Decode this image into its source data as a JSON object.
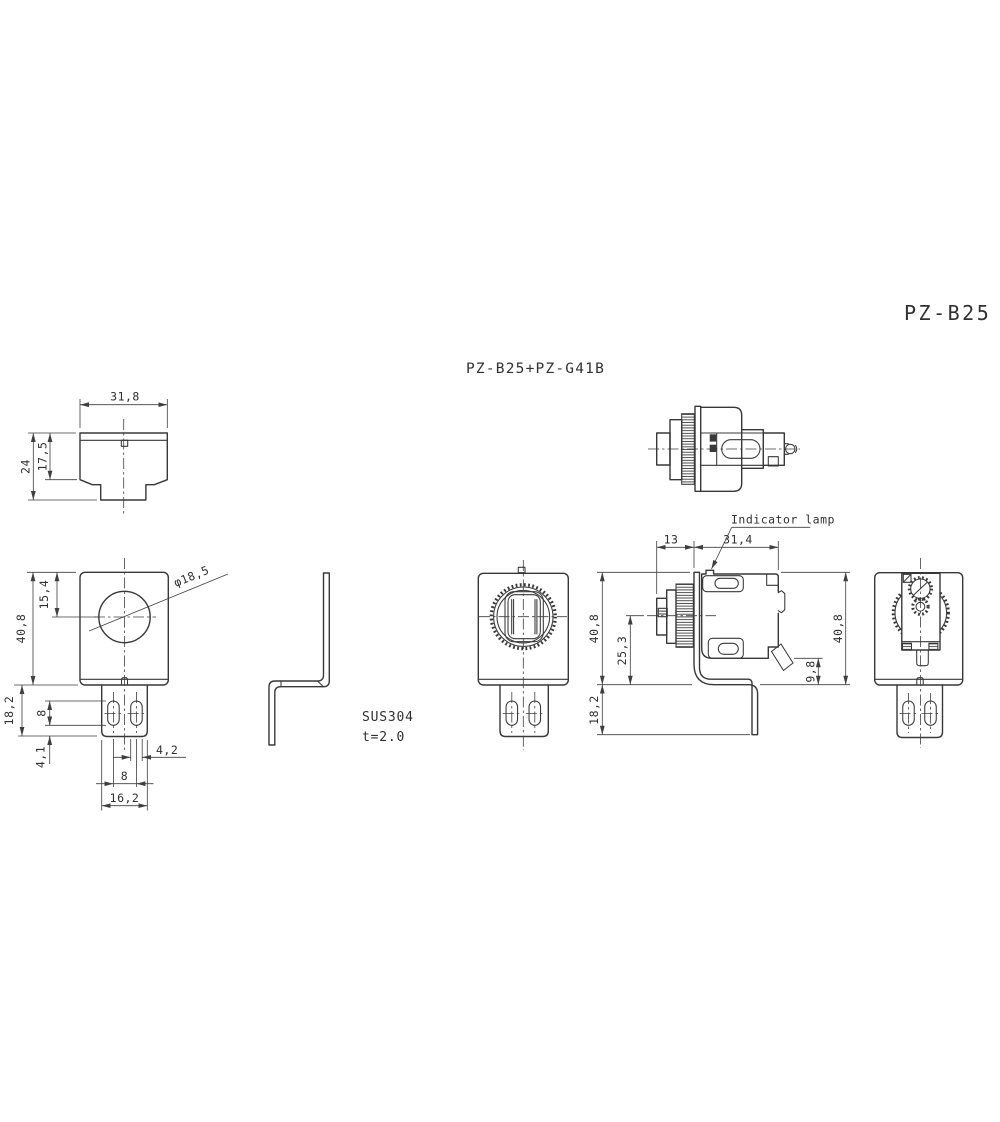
{
  "drawing": {
    "title": "PZ-B25",
    "subtitle": "PZ-B25+PZ-G41B",
    "callout": "Indicator lamp",
    "material": {
      "grade": "SUS304",
      "thickness": "t=2.0"
    },
    "top": {
      "width": "31,8",
      "height": "24",
      "inner_height": "17,5"
    },
    "front": {
      "height": "40,8",
      "hole_offset": "15,4",
      "hole_dia": "φ18,5",
      "leg_height": "18,2",
      "slot_length": "8",
      "slot_end": "4,1",
      "slot_width": "4,2",
      "slot_pitch": "8",
      "leg_width": "16,2"
    },
    "side": {
      "front_depth": "13",
      "body_depth": "31,4",
      "height_left": "40,8",
      "center_height": "25,3",
      "lever_offset": "9,8",
      "height_right": "40,8",
      "leg_height": "18,2"
    }
  }
}
